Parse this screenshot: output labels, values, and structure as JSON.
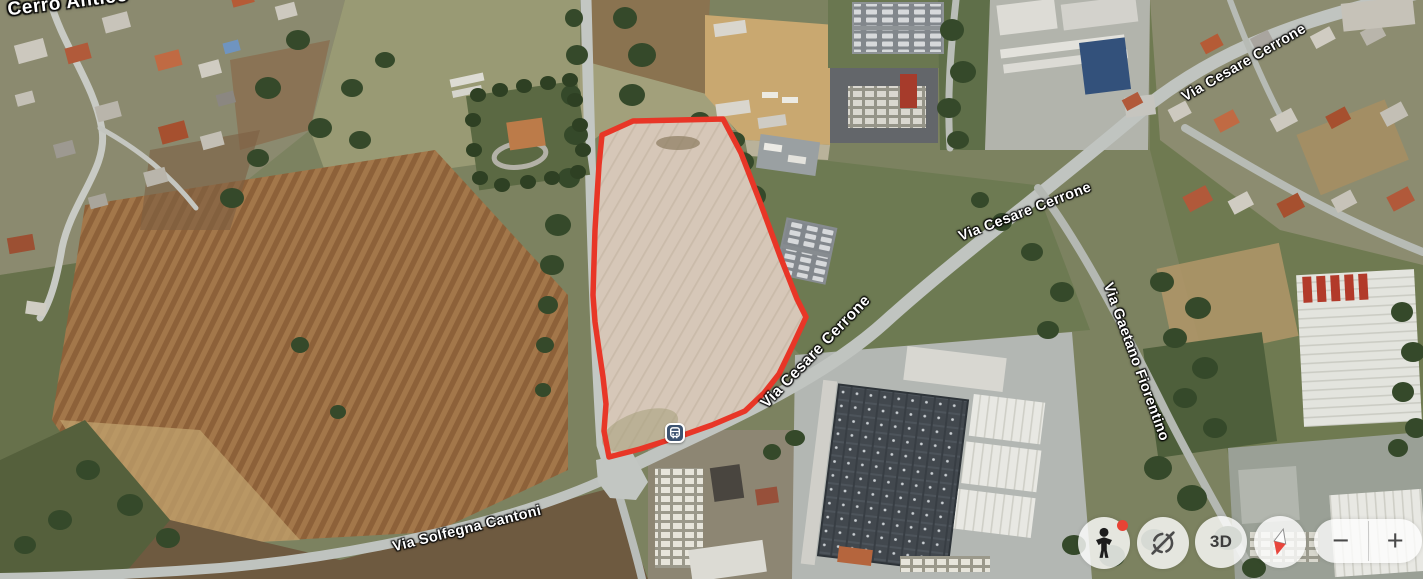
{
  "map": {
    "place_label": "Cerro Antico",
    "road_labels": [
      {
        "id": "via-cesare-cerrone-mid",
        "text": "Via Cesare Cerrone"
      },
      {
        "id": "via-cesare-cerrone-lower",
        "text": "Via Cesare Cerrone"
      },
      {
        "id": "via-cesare-cerrone-topright",
        "text": "Via Cesare Cerrone"
      },
      {
        "id": "via-gaetano-fiorentino",
        "text": "Via Gaetano Fiorentino"
      },
      {
        "id": "via-solfegna-cantoni",
        "text": "Via Solfegna Cantoni"
      }
    ],
    "markers": [
      {
        "id": "bus-stop",
        "icon": "bus-stop-icon",
        "color": "#3d5370"
      }
    ],
    "overlay": {
      "parcel_outline_color": "#e83627"
    }
  },
  "controls": {
    "pegman": {
      "icon": "pegman-icon",
      "notification_color": "#e84335"
    },
    "auto_rotate": {
      "icon": "auto-rotate-off-icon"
    },
    "three_d": {
      "label": "3D"
    },
    "compass": {
      "icon": "compass-needle-icon",
      "needle_color": "#e8453c"
    },
    "zoom": {
      "out_label": "−",
      "in_label": "+"
    }
  }
}
